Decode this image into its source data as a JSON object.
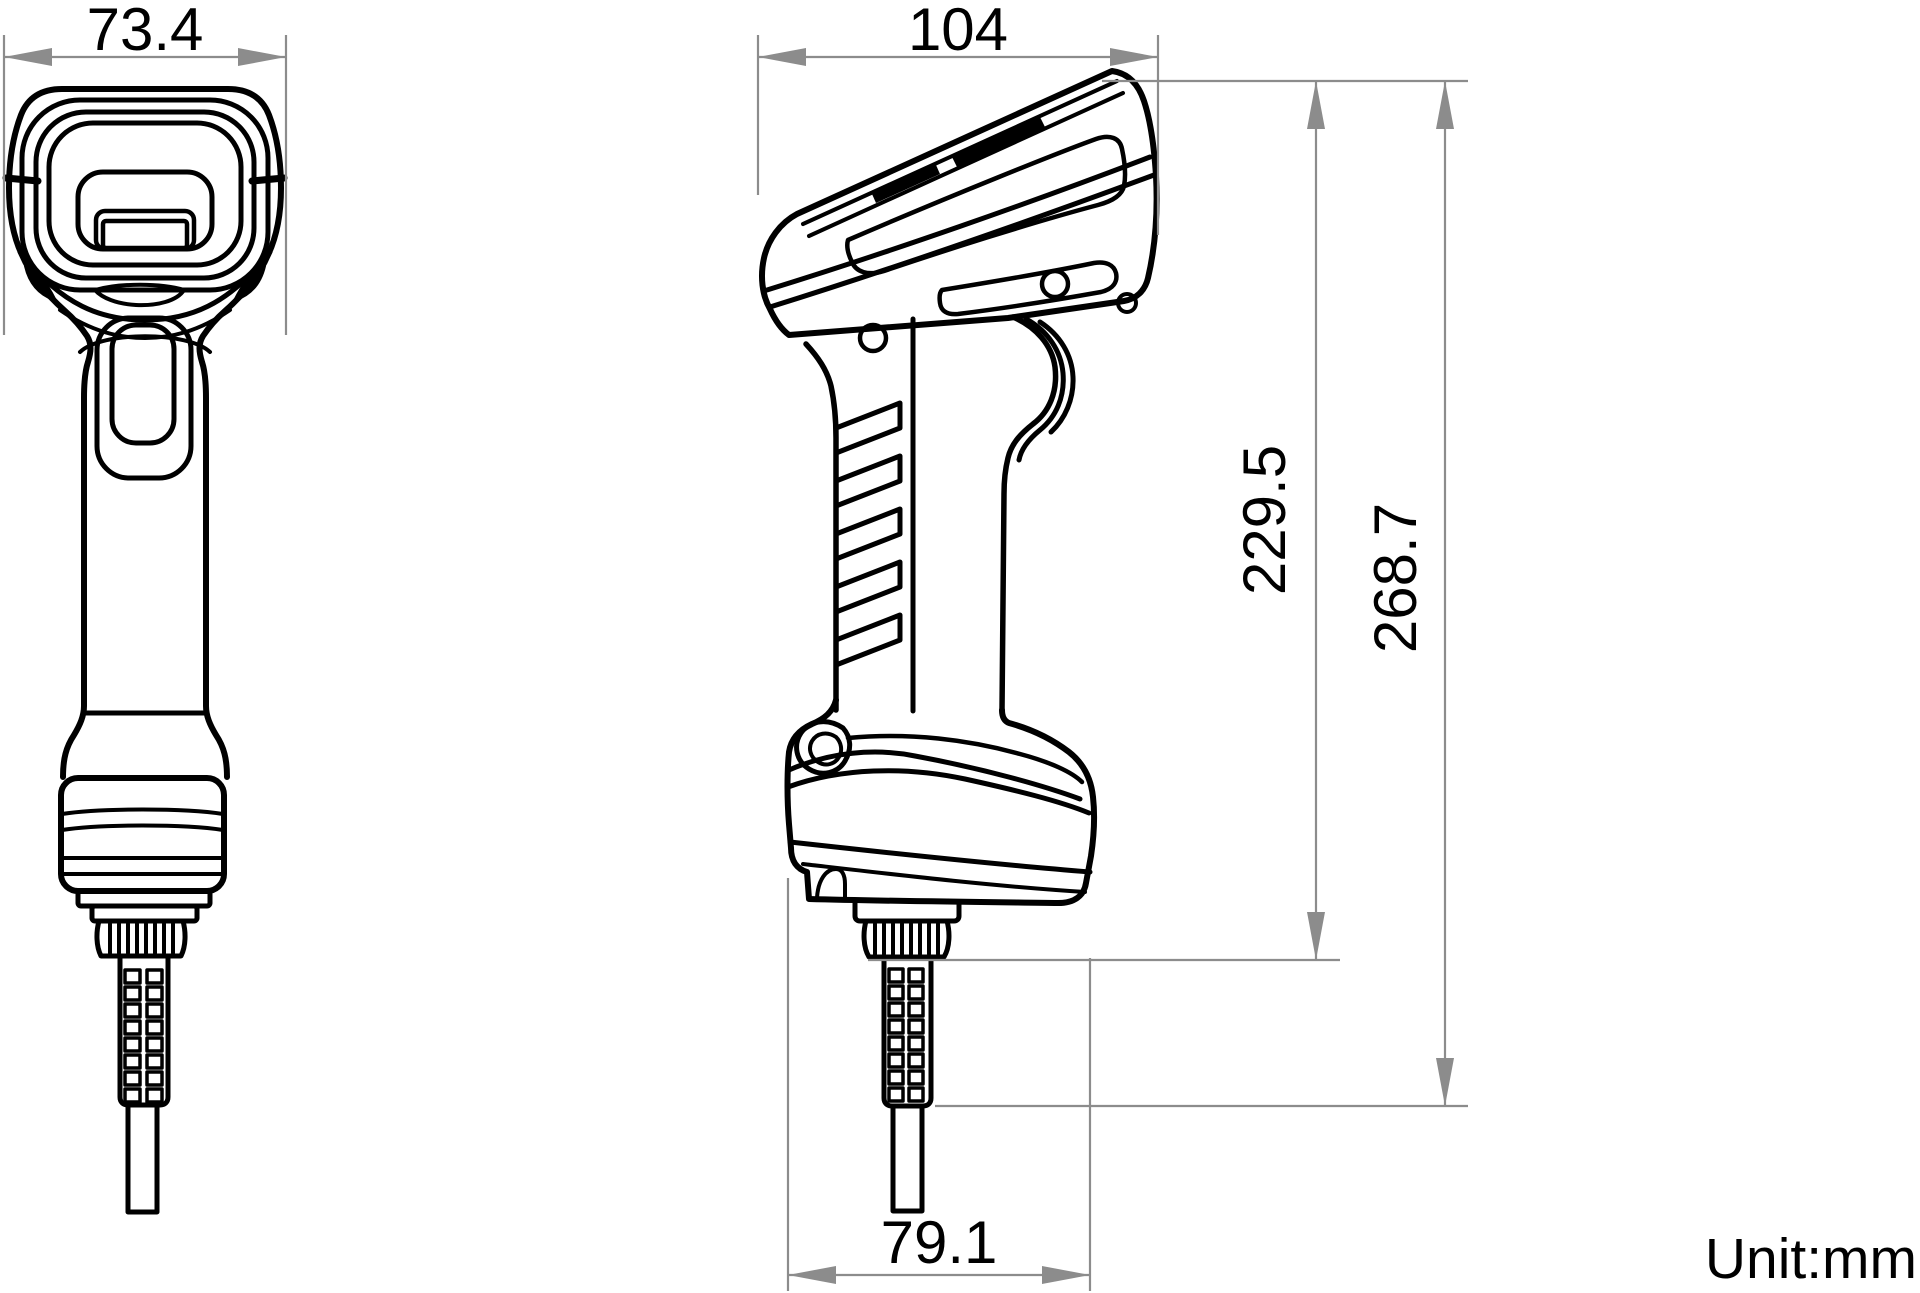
{
  "drawing": {
    "unit_label": "Unit:mm",
    "dimensions": {
      "front_width": "73.4",
      "side_width": "104",
      "body_height": "229.5",
      "total_height": "268.7",
      "base_width": "79.1"
    },
    "colors": {
      "outline": "#000000",
      "dimension_gray": "#8c8c8c",
      "background": "#ffffff"
    }
  }
}
